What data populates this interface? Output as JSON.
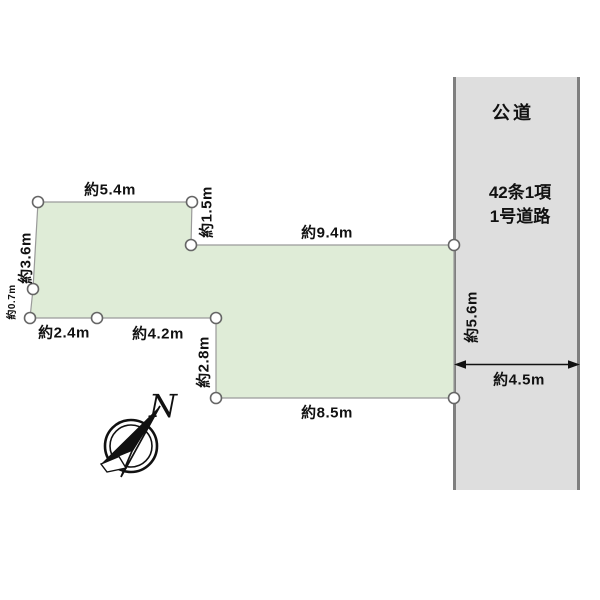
{
  "title": "土地区画図",
  "colors": {
    "background": "#ffffff",
    "land_fill": "#dfecd7",
    "land_stroke": "#9a9a9a",
    "road_fill": "#dedede",
    "road_border": "#7f7f7f",
    "ink": "#111111",
    "marker_fill": "#ffffff",
    "marker_stroke": "#666666"
  },
  "road": {
    "title": "公道",
    "regulation_line1": "42条1項",
    "regulation_line2": "1号道路",
    "width": "約4.5m"
  },
  "dimensions": {
    "top_edge": "約5.4m",
    "step_edge": "約1.5m",
    "upper_edge": "約9.4m",
    "left_edge": "約3.6m",
    "left_small_edge": "約0.7m",
    "bottom_left_edge_1": "約2.4m",
    "bottom_left_edge_2": "約4.2m",
    "notch_edge": "約2.8m",
    "bottom_edge": "約8.5m",
    "road_frontage": "約5.6m"
  },
  "compass": {
    "north_label": "N"
  }
}
